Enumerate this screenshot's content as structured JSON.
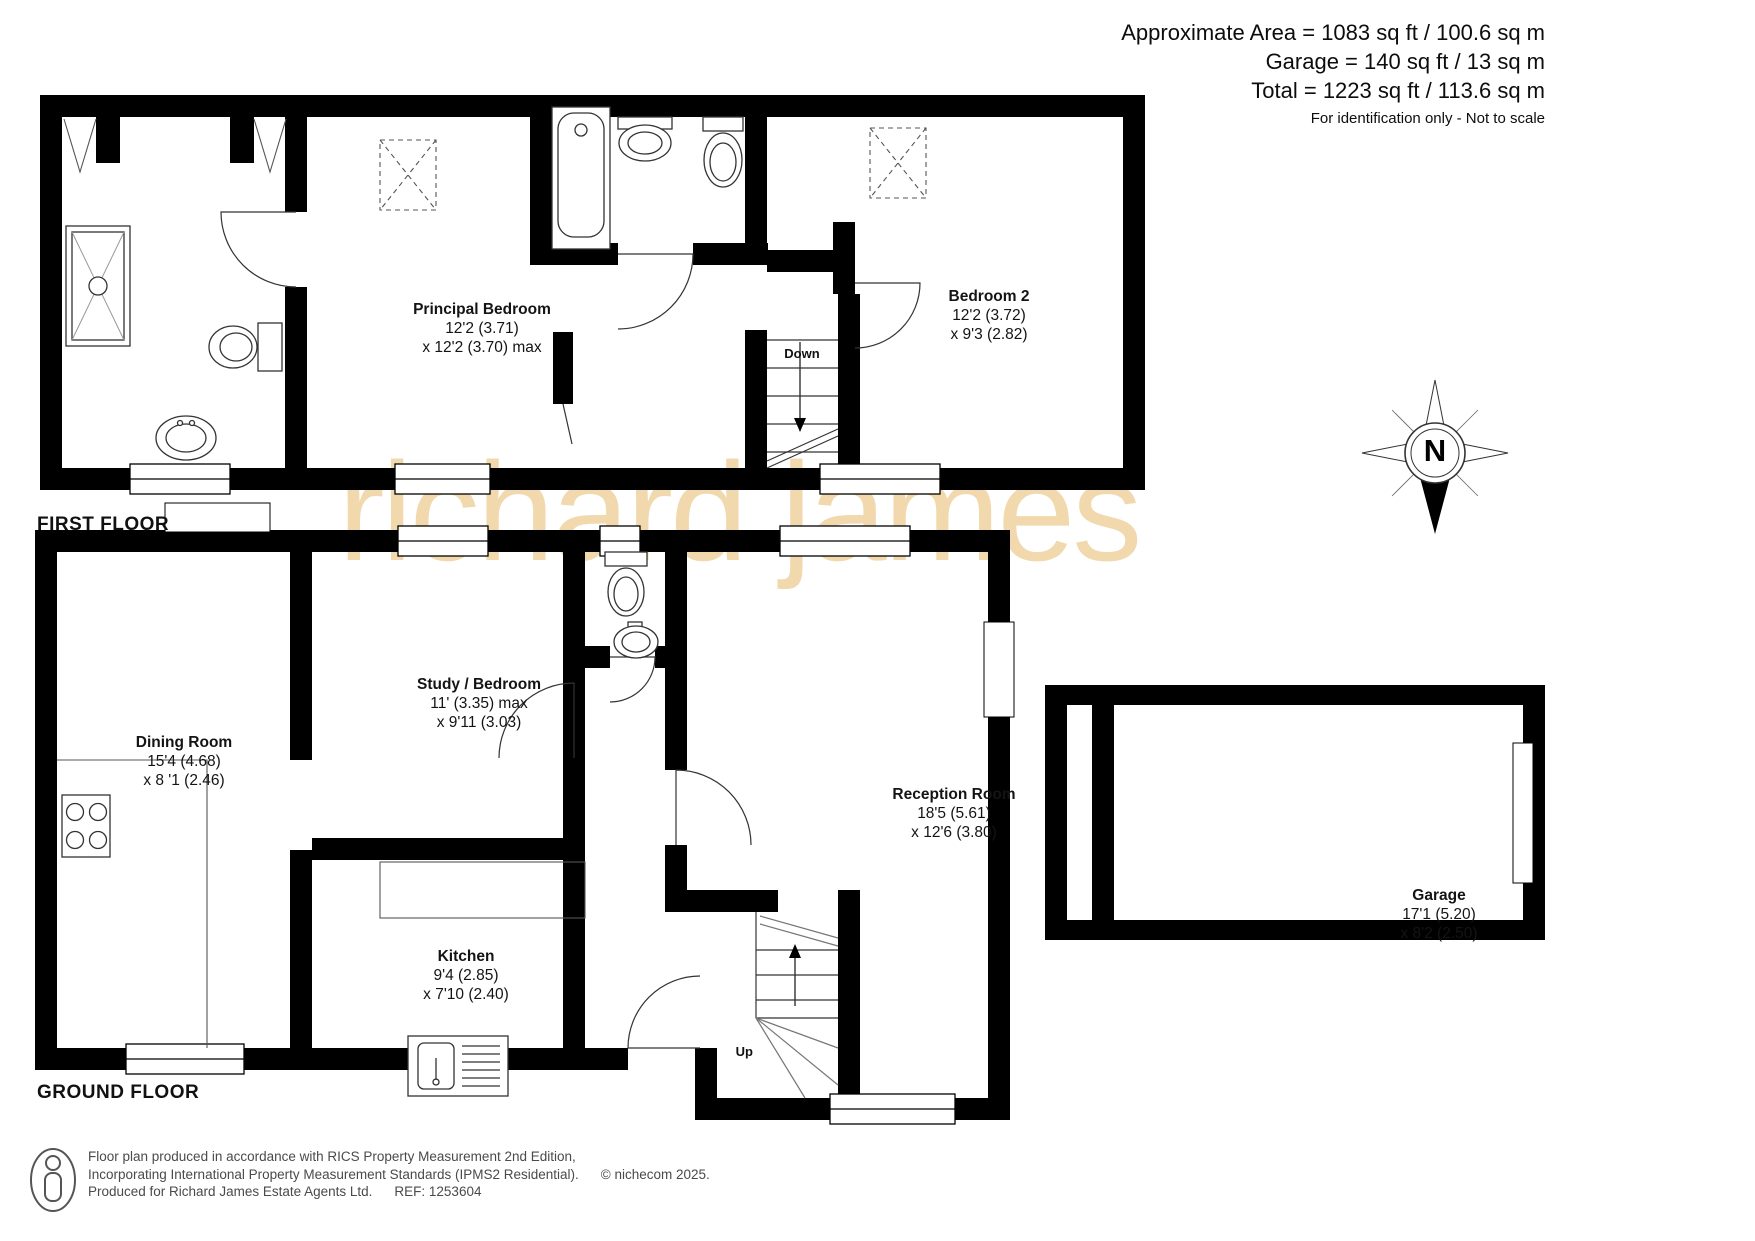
{
  "header": {
    "line1": "Approximate Area = 1083 sq ft / 100.6 sq m",
    "line2": "Garage = 140 sq ft / 13 sq m",
    "line3": "Total = 1223 sq ft / 113.6 sq m",
    "note": "For identification only - Not to scale"
  },
  "watermark": "richard james",
  "compass": {
    "north_label": "N"
  },
  "floors": {
    "first": {
      "label": "FIRST FLOOR"
    },
    "ground": {
      "label": "GROUND FLOOR"
    }
  },
  "rooms": {
    "principal_bedroom": {
      "name": "Principal Bedroom",
      "dim1": "12'2 (3.71)",
      "dim2": "x 12'2 (3.70) max"
    },
    "bedroom2": {
      "name": "Bedroom 2",
      "dim1": "12'2 (3.72)",
      "dim2": "x 9'3 (2.82)"
    },
    "dining": {
      "name": "Dining Room",
      "dim1": "15'4 (4.68)",
      "dim2": "x 8 '1 (2.46)"
    },
    "study": {
      "name": "Study / Bedroom",
      "dim1": "11' (3.35) max",
      "dim2": "x 9'11 (3.03)"
    },
    "kitchen": {
      "name": "Kitchen",
      "dim1": "9'4 (2.85)",
      "dim2": "x 7'10 (2.40)"
    },
    "reception": {
      "name": "Reception Room",
      "dim1": "18'5 (5.61)",
      "dim2": "x 12'6 (3.80)"
    },
    "garage": {
      "name": "Garage",
      "dim1": "17'1 (5.20)",
      "dim2": "x 8'2 (2.50)"
    }
  },
  "stairs": {
    "down": "Down",
    "up": "Up"
  },
  "footer": {
    "line1": "Floor plan produced in accordance with RICS Property Measurement 2nd Edition,",
    "line2": "Incorporating International Property Measurement Standards (IPMS2 Residential).",
    "copyright": "© nichecom 2025.",
    "line3": "Produced for Richard James Estate Agents Ltd.",
    "ref": "REF: 1253604"
  },
  "colors": {
    "wall": "#000000",
    "line": "#333333",
    "watermark": "#f1d9ad"
  }
}
